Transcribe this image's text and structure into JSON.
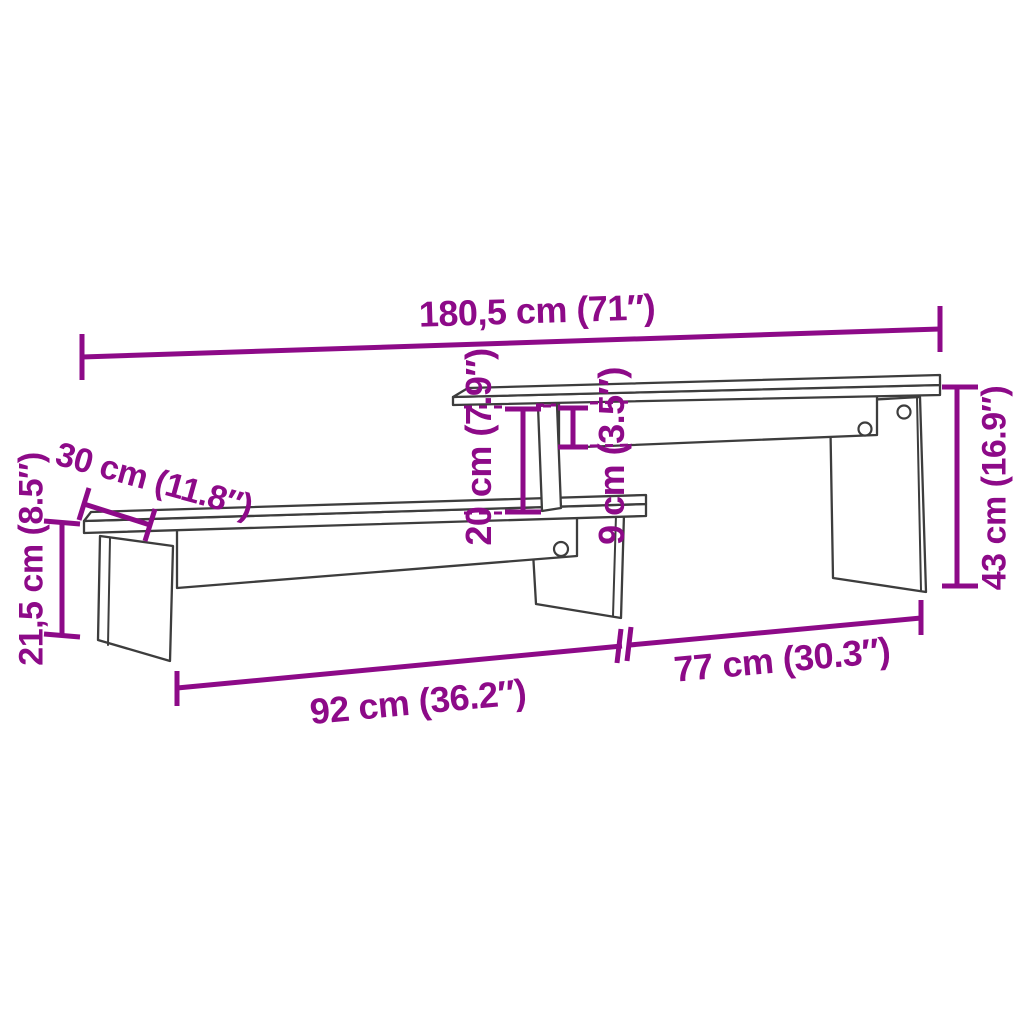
{
  "colors": {
    "dimension": "#8D0A88",
    "outline": "#3D3D3D",
    "background": "#FFFFFF"
  },
  "diagram": {
    "type": "furniture dimension diagram",
    "subject": "two-tier TV stand / media shelf line drawing",
    "labels": {
      "total_width": "180,5 cm (71″)",
      "depth": "30 cm (11.8″)",
      "lower_height": "21,5 cm (8.5″)",
      "tier_gap": "20 cm (7.9″)",
      "rail_height": "9 cm (3.5″)",
      "upper_height": "43 cm (16.9″)",
      "lower_length": "92 cm (36.2″)",
      "upper_length": "77 cm (30.3″)"
    }
  }
}
